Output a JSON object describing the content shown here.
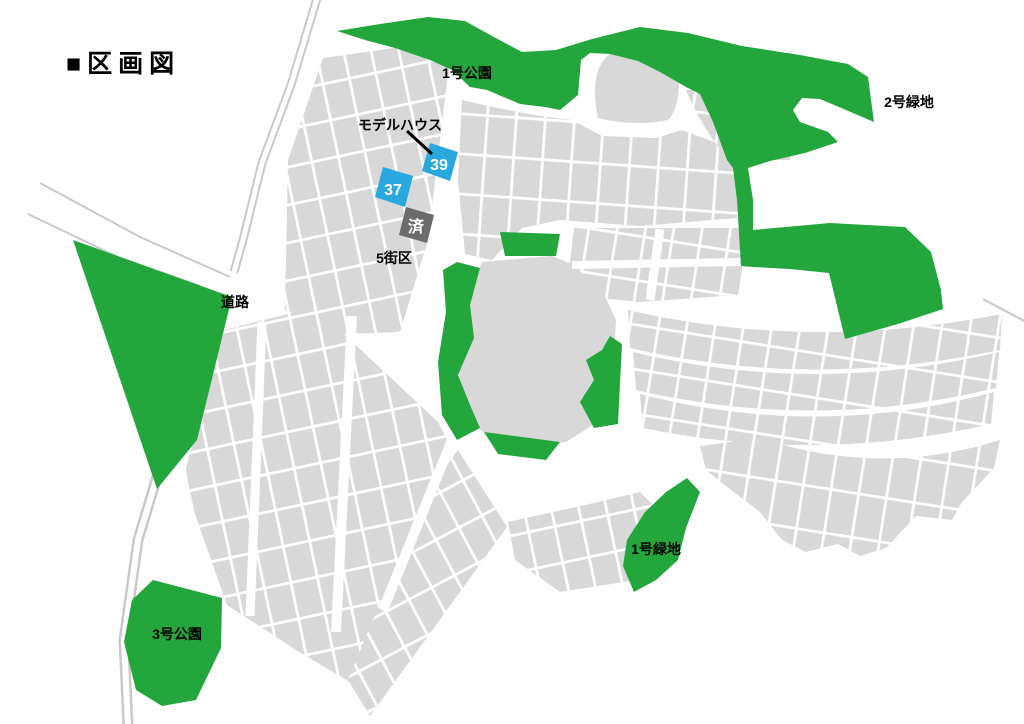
{
  "title": "■区画図",
  "labels": {
    "park1": "1号公園",
    "green2": "2号緑地",
    "green1": "1号緑地",
    "park3": "3号公園",
    "road": "道路",
    "block5": "5街区",
    "model_house": "モデルハウス"
  },
  "lots": {
    "lot39": {
      "number": "39",
      "color": "#29a8e0",
      "status": "available"
    },
    "lot37": {
      "number": "37",
      "color": "#29a8e0",
      "status": "available"
    },
    "sold": {
      "label": "済",
      "color": "#6b6b6b",
      "status": "sold"
    }
  },
  "colors": {
    "parcel_gray": "#d8d8d8",
    "green_area": "#23a73d",
    "road_white": "#ffffff",
    "thin_road_edge": "#c9c9c9",
    "text": "#000000"
  }
}
